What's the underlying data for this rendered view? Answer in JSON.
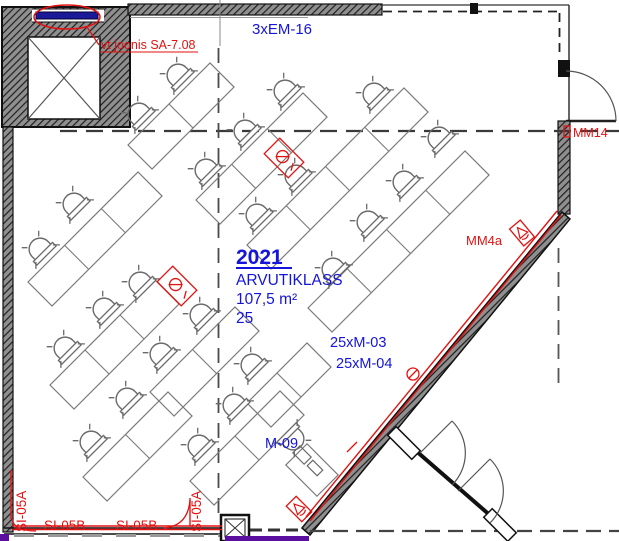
{
  "room": {
    "number": "2021",
    "name": "ARVUTIKLASS",
    "area": "107,5 m²",
    "capacity": "25"
  },
  "annotations": {
    "em16": "3xEM-16",
    "note": "vt joonis SA-7.08",
    "m03": "25xM-03",
    "m04": "25xM-04",
    "m09": "M-09",
    "mm14": "MM14",
    "mm4a": "MM4a",
    "si05a_left": "SI-05A",
    "si05b_1": "SI-05B",
    "si05b_2": "SI-05B",
    "si05a_right": "SI-05A"
  },
  "colors": {
    "annotation_blue": "#1414dd",
    "annotation_red": "#e31212",
    "cable_purple": "#5a0f9e",
    "wall_dark": "#2e2e2e",
    "desk_gray": "#7a7a7a",
    "em_bar_blue": "#1a1a99"
  },
  "plan": {
    "chains": [
      {
        "x1": 128,
        "y1": 145,
        "x2": 210,
        "y2": 63
      },
      {
        "x1": 196,
        "y1": 200,
        "x2": 303,
        "y2": 93
      },
      {
        "x1": 247,
        "y1": 245,
        "x2": 404,
        "y2": 88
      },
      {
        "x1": 308,
        "y1": 308,
        "x2": 465,
        "y2": 151
      },
      {
        "x1": 28,
        "y1": 282,
        "x2": 138,
        "y2": 172
      },
      {
        "x1": 50,
        "y1": 385,
        "x2": 155,
        "y2": 280
      },
      {
        "x1": 83,
        "y1": 477,
        "x2": 168,
        "y2": 392
      },
      {
        "x1": 150,
        "y1": 392,
        "x2": 235,
        "y2": 307
      },
      {
        "x1": 190,
        "y1": 481,
        "x2": 280,
        "y2": 391
      },
      {
        "x1": 247,
        "y1": 403,
        "x2": 307,
        "y2": 343
      }
    ],
    "chairs": [
      {
        "x": 176,
        "y": 73,
        "r": 135
      },
      {
        "x": 137,
        "y": 112,
        "r": 135
      },
      {
        "x": 283,
        "y": 89,
        "r": 135
      },
      {
        "x": 243,
        "y": 129,
        "r": 135
      },
      {
        "x": 204,
        "y": 168,
        "r": 135
      },
      {
        "x": 372,
        "y": 92,
        "r": 135
      },
      {
        "x": 294,
        "y": 174,
        "r": 135
      },
      {
        "x": 255,
        "y": 213,
        "r": 135
      },
      {
        "x": 437,
        "y": 136,
        "r": 135
      },
      {
        "x": 402,
        "y": 180,
        "r": 135
      },
      {
        "x": 366,
        "y": 220,
        "r": 135
      },
      {
        "x": 331,
        "y": 267,
        "r": 135
      },
      {
        "x": 72,
        "y": 202,
        "r": 135
      },
      {
        "x": 38,
        "y": 247,
        "r": 135
      },
      {
        "x": 63,
        "y": 346,
        "r": 135
      },
      {
        "x": 102,
        "y": 307,
        "r": 135
      },
      {
        "x": 138,
        "y": 281,
        "r": 135
      },
      {
        "x": 89,
        "y": 440,
        "r": 135
      },
      {
        "x": 125,
        "y": 397,
        "r": 135
      },
      {
        "x": 159,
        "y": 352,
        "r": 135
      },
      {
        "x": 199,
        "y": 313,
        "r": 135
      },
      {
        "x": 197,
        "y": 444,
        "r": 135
      },
      {
        "x": 232,
        "y": 403,
        "r": 135
      },
      {
        "x": 250,
        "y": 363,
        "r": 135
      }
    ],
    "floor_outlets": [
      {
        "x": 284,
        "y": 158,
        "r": 45
      },
      {
        "x": 177,
        "y": 286,
        "r": 45
      }
    ],
    "speakers": [
      {
        "x": 299,
        "y": 509,
        "r": 45
      },
      {
        "x": 522,
        "y": 233,
        "r": 50
      }
    ],
    "outlet_circle": {
      "x": 413,
      "y": 374
    },
    "cable_tick": {
      "x1": 347,
      "y1": 452,
      "x2": 357,
      "y2": 442
    },
    "teacher": {
      "desk_x": 312,
      "desk_y": 470,
      "chair_x": 295,
      "chair_y": 441,
      "chair_r": -45
    }
  }
}
